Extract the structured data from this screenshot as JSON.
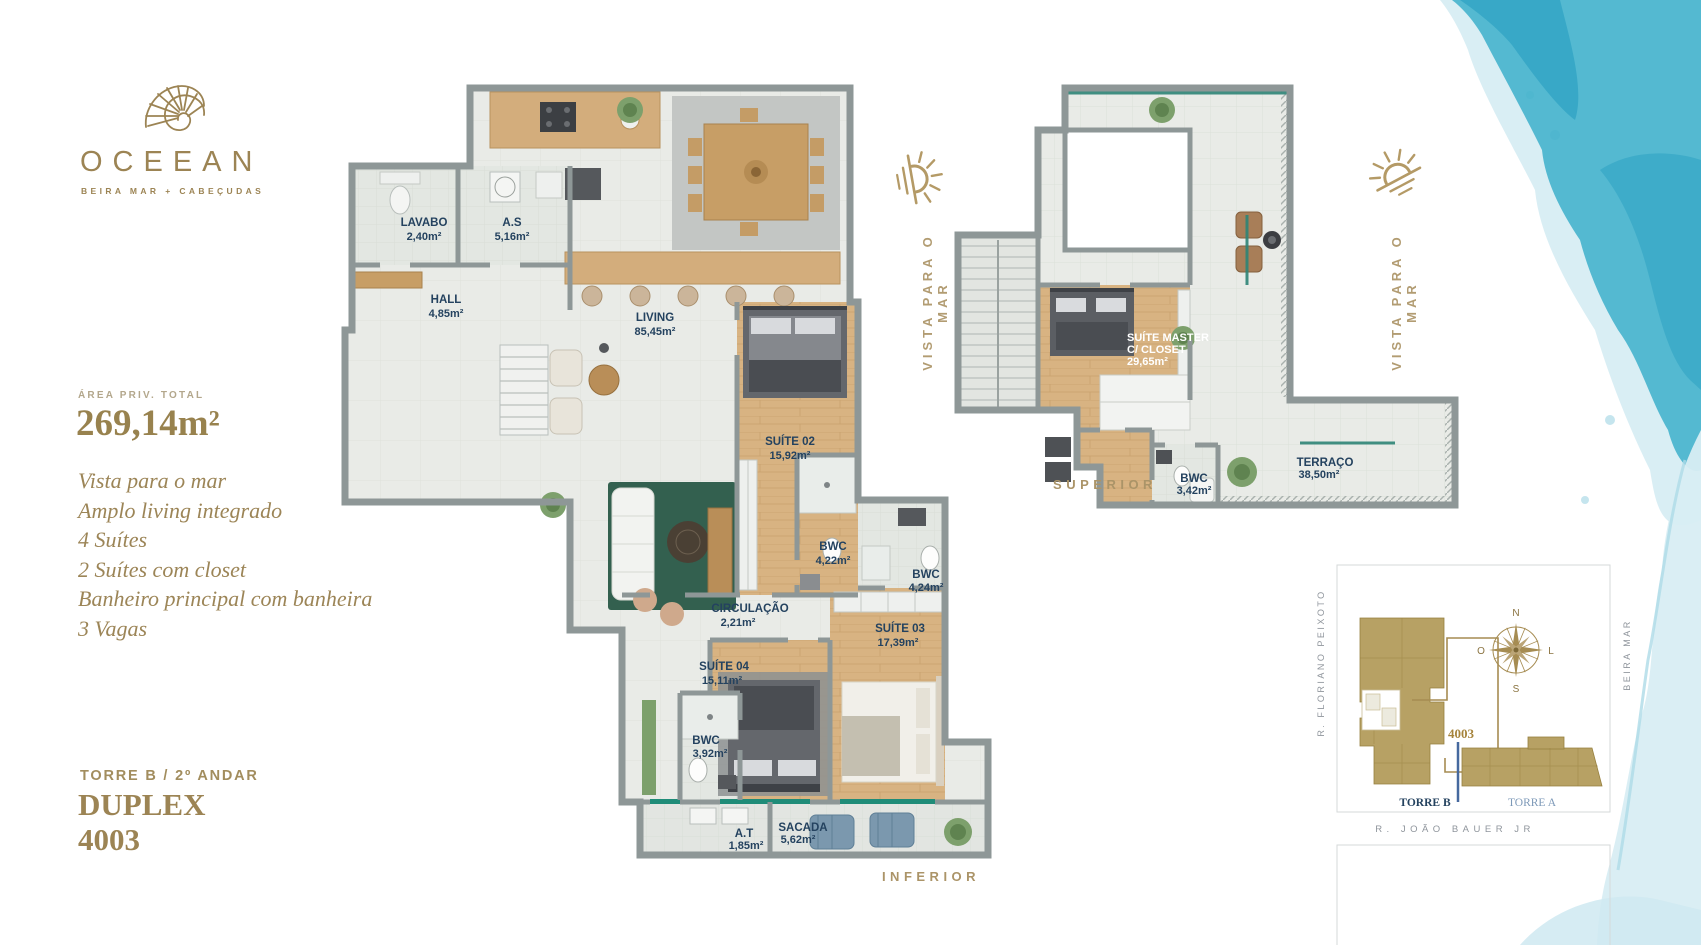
{
  "brand": {
    "name": "OCEEAN",
    "tagline": "BEIRA MAR + CABEÇUDAS"
  },
  "summary": {
    "area_label": "ÁREA PRIV. TOTAL",
    "area_value": "269,14m²",
    "features": [
      "Vista para o mar",
      "Amplo living integrado",
      "4 Suítes",
      "2 Suítes com closet",
      "Banheiro principal com banheira",
      "3 Vagas"
    ]
  },
  "unit": {
    "tower_floor": "TORRE B / 2º ANDAR",
    "type": "DUPLEX",
    "number": "4003"
  },
  "vista_label": "VISTA PARA O MAR",
  "plans": {
    "inferior": {
      "caption": "INFERIOR",
      "rooms": {
        "lavabo": {
          "name": "LAVABO",
          "area": "2,40m²"
        },
        "as": {
          "name": "A.S",
          "area": "5,16m²"
        },
        "hall": {
          "name": "HALL",
          "area": "4,85m²"
        },
        "living": {
          "name": "LIVING",
          "area": "85,45m²"
        },
        "suite02": {
          "name": "SUÍTE 02",
          "area": "15,92m²"
        },
        "bwc1": {
          "name": "BWC",
          "area": "4,22m²"
        },
        "bwc2": {
          "name": "BWC",
          "area": "4,24m²"
        },
        "circulacao": {
          "name": "CIRCULAÇÃO",
          "area": "2,21m²"
        },
        "suite03": {
          "name": "SUÍTE 03",
          "area": "17,39m²"
        },
        "suite04": {
          "name": "SUÍTE 04",
          "area": "15,11m²"
        },
        "bwc3": {
          "name": "BWC",
          "area": "3,92m²"
        },
        "at": {
          "name": "A.T",
          "area": "1,85m²"
        },
        "sacada": {
          "name": "SACADA",
          "area": "5,62m²"
        }
      }
    },
    "superior": {
      "caption": "SUPERIOR",
      "rooms": {
        "master": {
          "line1": "SUÍTE MASTER",
          "line2": "C/ CLOSET",
          "area": "29,65m²"
        },
        "bwc": {
          "name": "BWC",
          "area": "3,42m²"
        },
        "terraco": {
          "name": "TERRAÇO",
          "area": "38,50m²"
        }
      }
    }
  },
  "sitemap": {
    "street_left": "R. FLORIANO PEIXOTO",
    "street_bottom": "R. JOÃO BAUER JR",
    "street_right": "BEIRA MAR",
    "tower_b": "TORRE B",
    "tower_a": "TORRE A",
    "unit_number": "4003",
    "compass": {
      "n": "N",
      "s": "S",
      "w": "O",
      "e": "L"
    }
  },
  "colors": {
    "gold": "#9c8454",
    "navy": "#24425f",
    "watercolor": "#49b4cd"
  }
}
